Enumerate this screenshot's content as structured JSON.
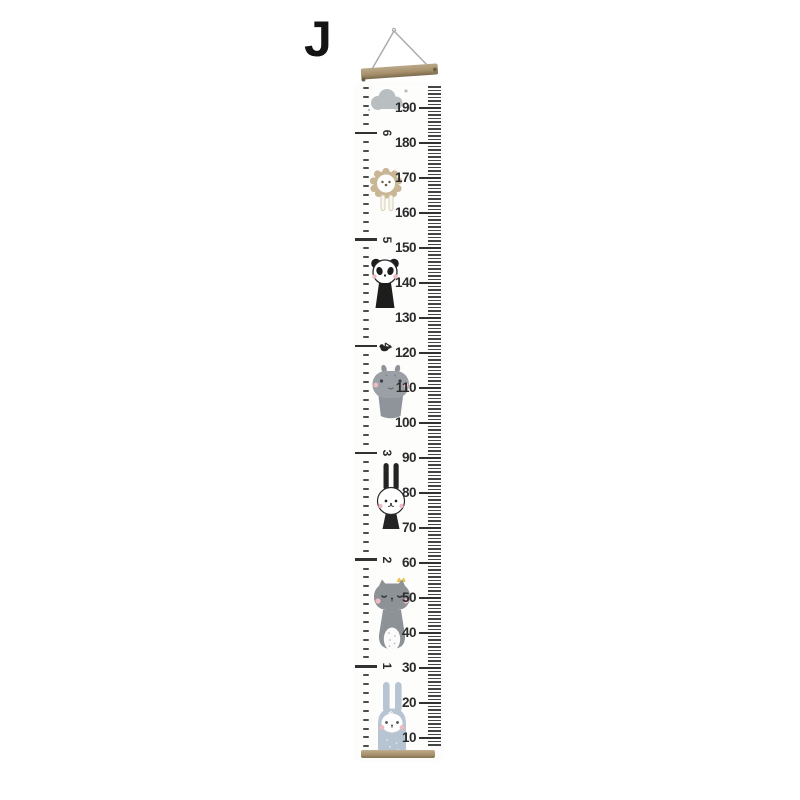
{
  "overlay": {
    "variant_label": "J"
  },
  "growth_chart": {
    "unit_cm_labels": [
      190,
      180,
      170,
      160,
      150,
      140,
      130,
      120,
      110,
      100,
      90,
      80,
      70,
      60,
      50,
      40,
      30,
      20,
      10
    ],
    "unit_feet_labels": [
      6,
      5,
      4,
      3,
      2,
      1
    ],
    "cm_tick_range": {
      "min": 8,
      "max": 196
    },
    "inch_tick_range": {
      "min": 3,
      "max": 77
    },
    "scale": {
      "cm_min": 10,
      "px_per_cm": 3.5,
      "baseline_local_y": 654
    },
    "colors": {
      "wood": "#a8916c",
      "tick": "#3f3f3f",
      "label": "#2b2b2b",
      "rope-gray": "#a9adb0",
      "cloud-gray": "#b9bec1",
      "lion-tan": "#c9b694",
      "panda-black": "#1d1d1d",
      "hippo-gray": "#9aa0a5",
      "hippo-gray-dark": "#8e949a",
      "rabbit-black": "#242424",
      "cat-gray": "#8d9297",
      "crown-yellow": "#e6c24b",
      "bunny-blue": "#b7c4d2",
      "cheek-pink": "#f2b9c2",
      "face-white": "#ffffff"
    },
    "illustrations": [
      {
        "name": "cloud",
        "cm_top": 196
      },
      {
        "name": "lion",
        "cm_top": 173
      },
      {
        "name": "panda",
        "cm_top": 147.5
      },
      {
        "name": "bird",
        "cm_top": 123
      },
      {
        "name": "hippo",
        "cm_top": 117
      },
      {
        "name": "rabbit",
        "cm_top": 88.5
      },
      {
        "name": "cat",
        "cm_top": 56
      },
      {
        "name": "bunny",
        "cm_top": 26
      }
    ]
  }
}
